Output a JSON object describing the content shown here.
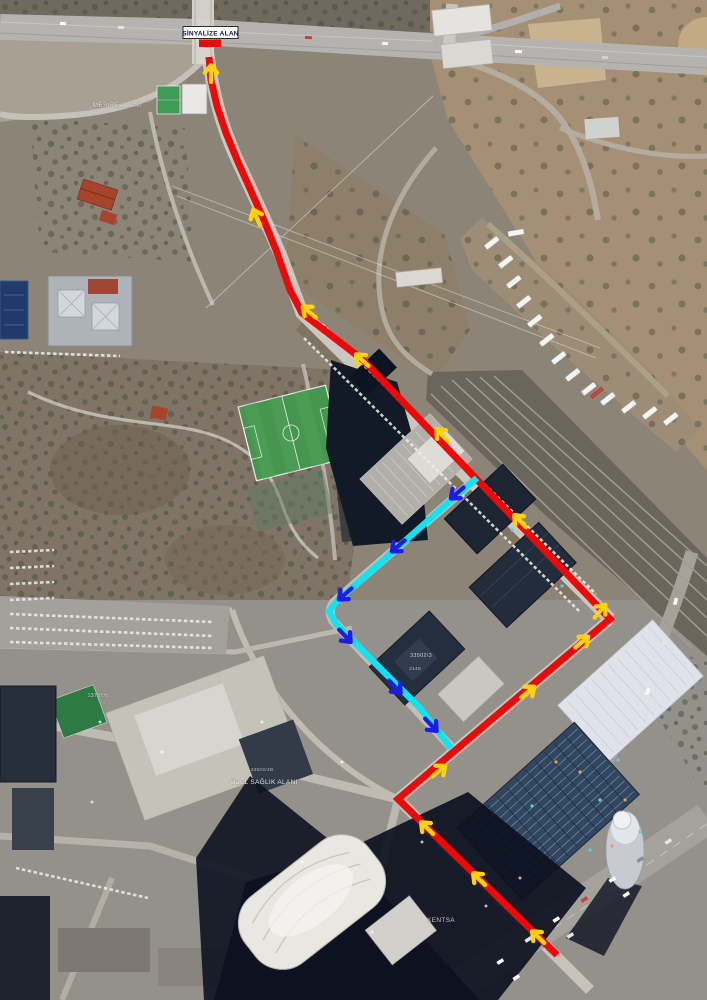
{
  "map": {
    "signal_label": {
      "text": "SİNYALİZE ALAN",
      "box": {
        "x": 183,
        "y": 26.5,
        "w": 55,
        "h": 12
      },
      "bar": {
        "x": 199,
        "y": 39.5,
        "w": 22,
        "h": 7.5
      },
      "text_color": "#10103a",
      "box_fill": "#ffffff",
      "box_border": "#1a1a1a",
      "bar_color": "#ea0a0a"
    },
    "colors": {
      "route_red": "#ee0808",
      "route_cyan": "#12e2f2",
      "arrow_yellow": "#ffd30a",
      "arrow_blue": "#1c1ce6"
    },
    "routes": [
      {
        "name": "red-route",
        "color_key": "route_red",
        "width": 7,
        "points": [
          [
            209,
            57
          ],
          [
            211,
            80
          ],
          [
            217,
            106
          ],
          [
            226,
            133
          ],
          [
            238,
            162
          ],
          [
            251,
            191
          ],
          [
            263,
            218
          ],
          [
            276,
            250
          ],
          [
            290,
            290
          ],
          [
            302,
            313
          ],
          [
            363,
            360
          ],
          [
            610,
            619
          ],
          [
            398,
            799
          ],
          [
            557,
            955
          ]
        ]
      },
      {
        "name": "cyan-route",
        "color_key": "route_cyan",
        "width": 6.5,
        "points": [
          [
            477,
            478
          ],
          [
            449,
            502
          ],
          [
            397,
            548
          ],
          [
            337,
            601
          ],
          [
            329,
            611
          ],
          [
            336,
            624
          ],
          [
            379,
            667
          ],
          [
            419,
            707
          ],
          [
            451,
            748
          ]
        ]
      }
    ],
    "arrows": [
      {
        "x": 211,
        "y": 72,
        "angle": -90,
        "color_key": "arrow_yellow"
      },
      {
        "x": 256,
        "y": 216,
        "angle": -114,
        "color_key": "arrow_yellow"
      },
      {
        "x": 308,
        "y": 311,
        "angle": -140,
        "color_key": "arrow_yellow"
      },
      {
        "x": 361,
        "y": 359,
        "angle": -137,
        "color_key": "arrow_yellow"
      },
      {
        "x": 441,
        "y": 434,
        "angle": -134,
        "color_key": "arrow_yellow"
      },
      {
        "x": 519,
        "y": 520,
        "angle": -134,
        "color_key": "arrow_yellow"
      },
      {
        "x": 601,
        "y": 610,
        "angle": -50,
        "color_key": "arrow_yellow"
      },
      {
        "x": 583,
        "y": 641,
        "angle": -40,
        "color_key": "arrow_yellow"
      },
      {
        "x": 529,
        "y": 691,
        "angle": -40,
        "color_key": "arrow_yellow"
      },
      {
        "x": 440,
        "y": 770,
        "angle": -40,
        "color_key": "arrow_yellow"
      },
      {
        "x": 426,
        "y": 827,
        "angle": -136,
        "color_key": "arrow_yellow"
      },
      {
        "x": 478,
        "y": 878,
        "angle": -136,
        "color_key": "arrow_yellow"
      },
      {
        "x": 537,
        "y": 936,
        "angle": -136,
        "color_key": "arrow_yellow"
      },
      {
        "x": 456,
        "y": 494,
        "angle": 139,
        "color_key": "arrow_blue"
      },
      {
        "x": 397,
        "y": 547,
        "angle": 139,
        "color_key": "arrow_blue"
      },
      {
        "x": 344,
        "y": 595,
        "angle": 139,
        "color_key": "arrow_blue"
      },
      {
        "x": 346,
        "y": 637,
        "angle": 47,
        "color_key": "arrow_blue"
      },
      {
        "x": 396,
        "y": 688,
        "angle": 47,
        "color_key": "arrow_blue"
      },
      {
        "x": 432,
        "y": 726,
        "angle": 47,
        "color_key": "arrow_blue"
      }
    ],
    "watermarks": [
      {
        "text": "MESİRE ALANI",
        "x": 117,
        "y": 107,
        "size": 6.5,
        "opacity": 0.75
      },
      {
        "text": "ÖZEL SAĞLIK ALANI",
        "x": 264,
        "y": 784,
        "size": 6.5,
        "opacity": 0.9
      },
      {
        "text": "33502/2B",
        "x": 262,
        "y": 771,
        "size": 4.8,
        "opacity": 0.65
      },
      {
        "text": "33502/3",
        "x": 421,
        "y": 657,
        "size": 5.5,
        "opacity": 0.8
      },
      {
        "text": "2148",
        "x": 415,
        "y": 670,
        "size": 4.8,
        "opacity": 0.7
      },
      {
        "text": "13787/5",
        "x": 98,
        "y": 697,
        "size": 5.2,
        "opacity": 0.75
      },
      {
        "text": "KENTSA",
        "x": 441,
        "y": 922,
        "size": 6.5,
        "opacity": 0.75
      }
    ]
  }
}
